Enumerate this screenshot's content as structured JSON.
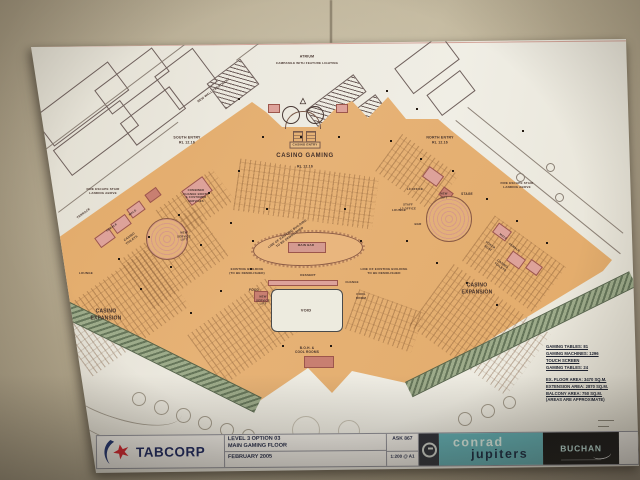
{
  "photo": {
    "wall_color": "#b3a78c",
    "sheet_color": "#ece9df",
    "floor_color": "#e2aa6a",
    "highlight_pink": "#dda29a",
    "balcony_green": "#8fa07c",
    "brand_teal": "#5fb0b5",
    "brand_navy": "#17225c",
    "brand_red": "#d6202a"
  },
  "plan": {
    "labels": {
      "atrium": "ATRIUM",
      "campanile": "CAMPANILE WITH FEATURE LIGHTING",
      "casino_entry": "CASINO ENTRY",
      "casino_gaming": "CASINO GAMING",
      "rl_level": "RL 12.16",
      "south_entry": "SOUTH ENTRY\nRL 12.16",
      "north_entry": "NORTH ENTRY\nRL 12.16",
      "new_wall_treatment": "NEW WALL TREATMENT",
      "fire_escape": "FIRE ESCAPE STAIR\nLANDING ABOVE",
      "terrace": "TERRACE",
      "male": "MALE",
      "female": "FEMALE",
      "casino_toilets": "CASINO\nTOILETS",
      "change_booth": "COMBINED\nCHANGE BOOTH\n& CUSTOMER\nSERVICES",
      "new_service_lift": "NEW\nSERVICE\nLIFT",
      "lounge": "LOUNGE",
      "casino_expansion": "CASINO\nEXPANSION",
      "main_bar": "MAIN BAR",
      "dessert": "DESSERT",
      "food": "FOOD",
      "change": "CHANGE",
      "cool_room": "COOL\nROOM",
      "void": "VOID",
      "boh": "B.O.H. &\nCOOL ROOMS",
      "demolish_line": "LINE OF EXISTING BUILDING\nTO BE DEMOLISHED",
      "existing_demolished": "EXISTING BUILDING\n(TO BE DEMOLISHED)",
      "stage": "STAGE",
      "l3_office": "L3 OFFICE",
      "staff_office": "STAFF\nL3 OFFICE",
      "bar": "BAR",
      "new_lift": "NEW\nLIFT",
      "poker_host": "POKER\nHOST"
    },
    "notes": {
      "lines": [
        "GAMING TABLES: 81",
        "GAMING MACHINES: 1296",
        "TOUCH SCREEN",
        "GAMING TABLES: 24",
        "EX. FLOOR AREA: 3470 SQ.M.",
        "EXTENSION AREA: 2870 SQ.M.",
        "BALCONY AREA: 750 SQ.M.",
        "(AREAS ARE APPROXIMATE)"
      ]
    }
  },
  "title_block": {
    "brand": "TABCORP",
    "title_line1": "LEVEL 3  OPTION 03",
    "title_line2": "MAIN GAMING FLOOR",
    "date": "FEBRUARY 2005",
    "drawing_ref": "ASK 867",
    "scale": "1:200 @ A1",
    "client_word1": "conrad",
    "client_word2": "jupiters",
    "firm": "BUCHAN"
  }
}
